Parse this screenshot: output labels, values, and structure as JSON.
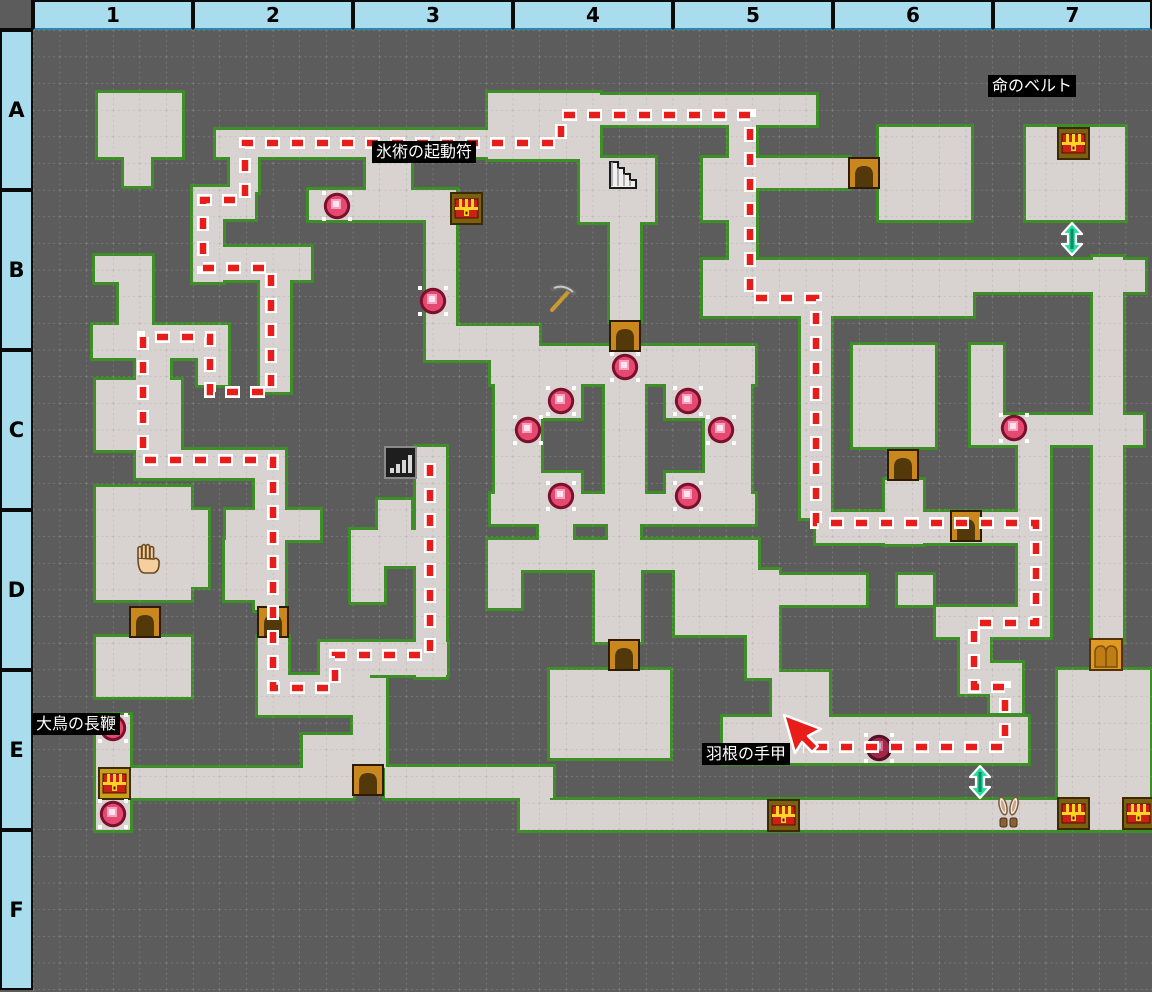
{
  "header": {
    "columns": [
      "1",
      "2",
      "3",
      "4",
      "5",
      "6",
      "7"
    ],
    "rows": [
      "A",
      "B",
      "C",
      "D",
      "E",
      "F"
    ]
  },
  "colors": {
    "wall": "#5c5c5c",
    "floor": "#d8d3d0",
    "floor_border": "#3e8e28",
    "grid": "#a2a2a2",
    "header_bg": "#a9dcec",
    "route": "#e81c18",
    "route_casing": "#ffffff",
    "label_bg": "#000000",
    "label_text": "#ffffff",
    "orb_main": "#e4496f",
    "door_frame": "#c9871d",
    "chest_red": "#cc2016",
    "teal_arrow": "#26dd9e"
  },
  "map": {
    "origin": {
      "x": 33,
      "y": 30
    },
    "size": {
      "w": 1119,
      "h": 962
    },
    "cell": 26.65,
    "floors": [
      [
        65,
        63,
        84,
        64
      ],
      [
        91,
        127,
        27,
        29
      ],
      [
        455,
        63,
        112,
        66
      ],
      [
        547,
        128,
        75,
        64
      ],
      [
        565,
        65,
        148,
        30
      ],
      [
        696,
        65,
        27,
        215
      ],
      [
        723,
        65,
        60,
        30
      ],
      [
        670,
        128,
        53,
        62
      ],
      [
        723,
        128,
        93,
        30
      ],
      [
        846,
        97,
        92,
        93
      ],
      [
        993,
        97,
        99,
        93
      ],
      [
        577,
        190,
        30,
        101
      ],
      [
        183,
        100,
        323,
        27
      ],
      [
        197,
        100,
        28,
        62
      ],
      [
        160,
        157,
        62,
        32
      ],
      [
        160,
        157,
        30,
        95
      ],
      [
        160,
        217,
        118,
        33
      ],
      [
        227,
        250,
        30,
        112
      ],
      [
        165,
        295,
        30,
        60
      ],
      [
        60,
        295,
        115,
        33
      ],
      [
        62,
        226,
        57,
        26
      ],
      [
        86,
        250,
        33,
        52
      ],
      [
        276,
        160,
        147,
        30
      ],
      [
        333,
        100,
        45,
        62
      ],
      [
        393,
        190,
        30,
        110
      ],
      [
        393,
        296,
        113,
        34
      ],
      [
        458,
        316,
        264,
        38
      ],
      [
        458,
        464,
        264,
        30
      ],
      [
        462,
        354,
        46,
        110
      ],
      [
        672,
        354,
        46,
        110
      ],
      [
        572,
        354,
        40,
        110
      ],
      [
        508,
        352,
        40,
        36
      ],
      [
        508,
        443,
        40,
        36
      ],
      [
        633,
        352,
        40,
        36
      ],
      [
        633,
        443,
        40,
        36
      ],
      [
        670,
        230,
        442,
        32
      ],
      [
        670,
        258,
        270,
        28
      ],
      [
        768,
        262,
        30,
        226
      ],
      [
        820,
        315,
        82,
        102
      ],
      [
        938,
        315,
        32,
        75
      ],
      [
        938,
        385,
        172,
        30
      ],
      [
        985,
        413,
        32,
        194
      ],
      [
        852,
        450,
        38,
        64
      ],
      [
        783,
        482,
        234,
        31
      ],
      [
        1060,
        227,
        30,
        385
      ],
      [
        903,
        577,
        104,
        30
      ],
      [
        927,
        607,
        30,
        57
      ],
      [
        927,
        633,
        62,
        31
      ],
      [
        957,
        633,
        32,
        50
      ],
      [
        63,
        350,
        85,
        70
      ],
      [
        103,
        328,
        34,
        95
      ],
      [
        103,
        420,
        135,
        28
      ],
      [
        222,
        420,
        30,
        160
      ],
      [
        383,
        417,
        30,
        230
      ],
      [
        120,
        480,
        55,
        77
      ],
      [
        193,
        480,
        94,
        30
      ],
      [
        192,
        510,
        31,
        60
      ],
      [
        63,
        457,
        95,
        113
      ],
      [
        318,
        500,
        95,
        36
      ],
      [
        318,
        536,
        33,
        36
      ],
      [
        345,
        470,
        33,
        30
      ],
      [
        455,
        510,
        270,
        30
      ],
      [
        455,
        540,
        33,
        38
      ],
      [
        506,
        464,
        34,
        50
      ],
      [
        562,
        540,
        46,
        72
      ],
      [
        575,
        494,
        32,
        48
      ],
      [
        642,
        540,
        104,
        65
      ],
      [
        714,
        540,
        32,
        108
      ],
      [
        746,
        545,
        87,
        30
      ],
      [
        865,
        545,
        35,
        30
      ],
      [
        517,
        640,
        120,
        88
      ],
      [
        739,
        642,
        57,
        48
      ],
      [
        690,
        687,
        305,
        46
      ],
      [
        63,
        607,
        95,
        60
      ],
      [
        225,
        607,
        30,
        45
      ],
      [
        225,
        645,
        112,
        40
      ],
      [
        287,
        612,
        127,
        33
      ],
      [
        63,
        685,
        34,
        115
      ],
      [
        97,
        738,
        223,
        30
      ],
      [
        270,
        705,
        50,
        63
      ],
      [
        320,
        648,
        33,
        90
      ],
      [
        352,
        737,
        168,
        31
      ],
      [
        487,
        738,
        30,
        62
      ],
      [
        487,
        770,
        633,
        30
      ],
      [
        1025,
        640,
        92,
        158
      ]
    ],
    "route": {
      "points": [
        [
          397,
          433
        ],
        [
          397,
          625
        ],
        [
          302,
          625
        ],
        [
          302,
          658
        ],
        [
          240,
          658
        ],
        [
          240,
          430
        ],
        [
          110,
          430
        ],
        [
          110,
          307
        ],
        [
          177,
          307
        ],
        [
          177,
          362
        ],
        [
          238,
          362
        ],
        [
          238,
          238
        ],
        [
          170,
          238
        ],
        [
          170,
          170
        ],
        [
          212,
          170
        ],
        [
          212,
          113
        ],
        [
          528,
          113
        ],
        [
          528,
          85
        ],
        [
          717,
          85
        ],
        [
          717,
          268
        ],
        [
          783,
          268
        ],
        [
          783,
          493
        ],
        [
          1003,
          493
        ],
        [
          1003,
          593
        ],
        [
          941,
          593
        ],
        [
          941,
          657
        ],
        [
          972,
          657
        ],
        [
          972,
          717
        ],
        [
          770,
          717
        ]
      ]
    },
    "cursor": {
      "x": 751,
      "y": 685
    },
    "doors": [
      {
        "x": 97,
        "y": 577,
        "type": "small"
      },
      {
        "x": 225,
        "y": 577,
        "type": "small"
      },
      {
        "x": 816,
        "y": 128,
        "type": "small"
      },
      {
        "x": 577,
        "y": 291,
        "type": "small"
      },
      {
        "x": 855,
        "y": 420,
        "type": "small"
      },
      {
        "x": 918,
        "y": 481,
        "type": "small"
      },
      {
        "x": 576,
        "y": 610,
        "type": "small"
      },
      {
        "x": 320,
        "y": 735,
        "type": "small"
      },
      {
        "x": 1057,
        "y": 609,
        "type": "double"
      }
    ],
    "chests": [
      {
        "x": 1025,
        "y": 98,
        "variant": "brown"
      },
      {
        "x": 418,
        "y": 163,
        "variant": "brown"
      },
      {
        "x": 66,
        "y": 738,
        "variant": "gold"
      },
      {
        "x": 735,
        "y": 770,
        "variant": "brown"
      },
      {
        "x": 1025,
        "y": 768,
        "variant": "brown"
      },
      {
        "x": 1090,
        "y": 768,
        "variant": "brown"
      }
    ],
    "orbs": [
      {
        "x": 304,
        "y": 176
      },
      {
        "x": 400,
        "y": 271
      },
      {
        "x": 592,
        "y": 337
      },
      {
        "x": 528,
        "y": 371
      },
      {
        "x": 655,
        "y": 371
      },
      {
        "x": 495,
        "y": 400
      },
      {
        "x": 688,
        "y": 400
      },
      {
        "x": 528,
        "y": 466
      },
      {
        "x": 655,
        "y": 466
      },
      {
        "x": 981,
        "y": 398
      },
      {
        "x": 846,
        "y": 718,
        "dark": true
      },
      {
        "x": 80,
        "y": 698
      },
      {
        "x": 80,
        "y": 784
      }
    ],
    "icons": [
      {
        "type": "stairs",
        "x": 573,
        "y": 128
      },
      {
        "type": "pickaxe",
        "x": 512,
        "y": 252
      },
      {
        "type": "hand",
        "x": 97,
        "y": 512
      },
      {
        "type": "bars",
        "x": 352,
        "y": 417
      },
      {
        "type": "rabbit",
        "x": 961,
        "y": 766
      },
      {
        "type": "updown",
        "x": 1028,
        "y": 193
      },
      {
        "type": "updown",
        "x": 936,
        "y": 736
      }
    ],
    "labels": [
      {
        "text": "命のベルト",
        "x": 988,
        "y": 75
      },
      {
        "text": "氷術の起動符",
        "x": 372,
        "y": 141
      },
      {
        "text": "大鳥の長鞭",
        "x": 32,
        "y": 713
      },
      {
        "text": "羽根の手甲",
        "x": 702,
        "y": 743
      }
    ]
  }
}
